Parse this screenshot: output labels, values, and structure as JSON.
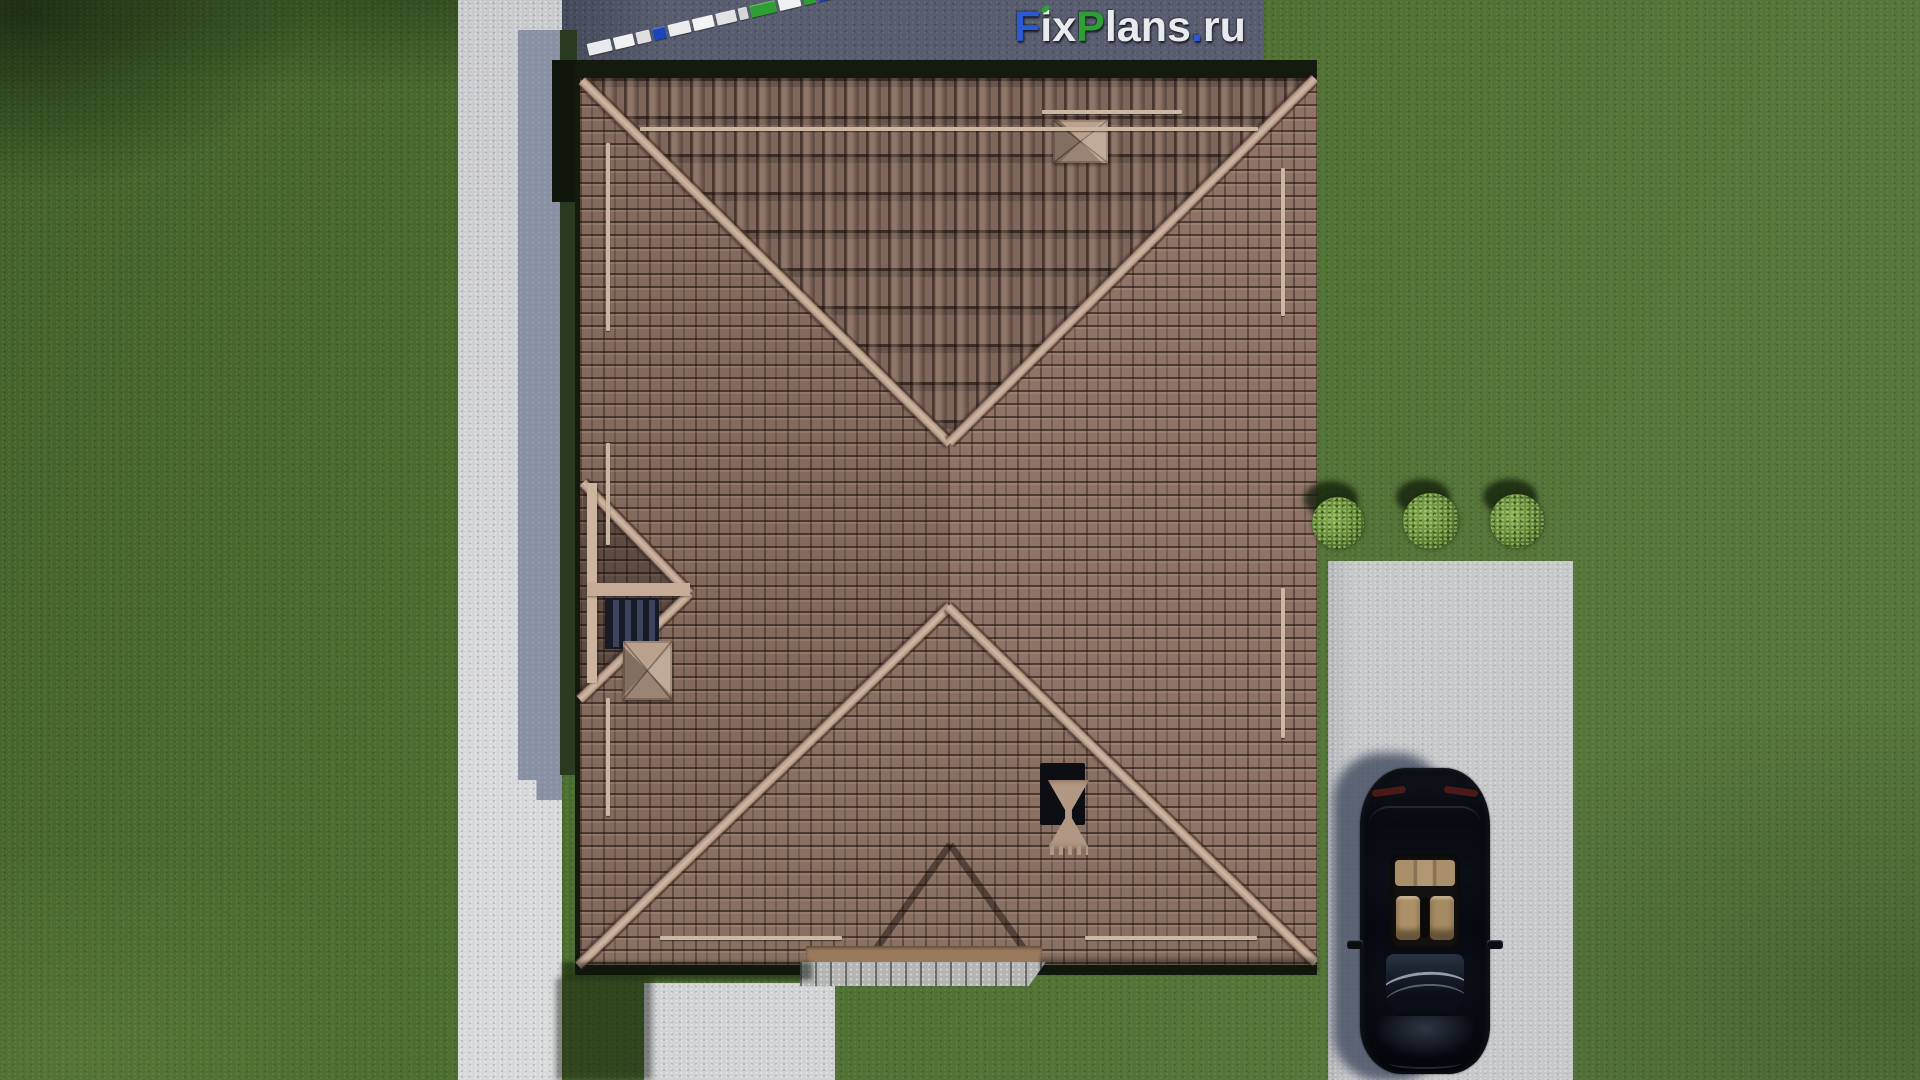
{
  "watermark": {
    "text": "FixPlans.ru",
    "leaf_color": "#2f9e33",
    "letters": [
      {
        "ch": "F",
        "color": "#2c5ad0"
      },
      {
        "ch": "i",
        "color": "#e9eaee",
        "leaf": true
      },
      {
        "ch": "x",
        "color": "#e9eaee"
      },
      {
        "ch": "P",
        "color": "#2f9e33"
      },
      {
        "ch": "l",
        "color": "#e9eaee"
      },
      {
        "ch": "a",
        "color": "#e9eaee"
      },
      {
        "ch": "n",
        "color": "#e9eaee"
      },
      {
        "ch": "s",
        "color": "#e9eaee"
      },
      {
        "ch": ".",
        "color": "#2c5ad0"
      },
      {
        "ch": "r",
        "color": "#e9eaee"
      },
      {
        "ch": "u",
        "color": "#e9eaee"
      }
    ]
  },
  "scale_bar": {
    "segments": [
      {
        "w": 24,
        "color": "#e8e9ea"
      },
      {
        "w": 20,
        "color": "#f1f1f2"
      },
      {
        "w": 14,
        "color": "#dfdfe1"
      },
      {
        "w": 13,
        "color": "#1c44bb"
      },
      {
        "w": 22,
        "color": "#ececee"
      },
      {
        "w": 21,
        "color": "#f3f3f4"
      },
      {
        "w": 20,
        "color": "#e2e2e4"
      },
      {
        "w": 9,
        "color": "#d6d6d8"
      },
      {
        "w": 26,
        "color": "#2f9e33"
      },
      {
        "w": 22,
        "color": "#eff0f1"
      },
      {
        "w": 12,
        "color": "#2f9e33"
      },
      {
        "w": 14,
        "color": "#1c44bb"
      }
    ]
  },
  "scene": {
    "view": "top-down-3d-site-render",
    "lawn_color": "#4d6e31",
    "walkway_color": "#cfd0d3",
    "driveway_color": "#c6c7c9",
    "cast_shadow_color": "#8a90a4",
    "roof": {
      "tile_color": "#86695b",
      "ridge_color": "#c3a995",
      "eave_color": "#141a0e",
      "snow_guard_color": "#cbb7a2",
      "chimney_count": 2,
      "roof_vent_count": 1,
      "skylight_color": "#2a3047"
    },
    "car": {
      "body_color": "#07090f",
      "interior_color": "#ab9168",
      "tail_light_color": "#82231c"
    },
    "bushes_count": 3
  }
}
